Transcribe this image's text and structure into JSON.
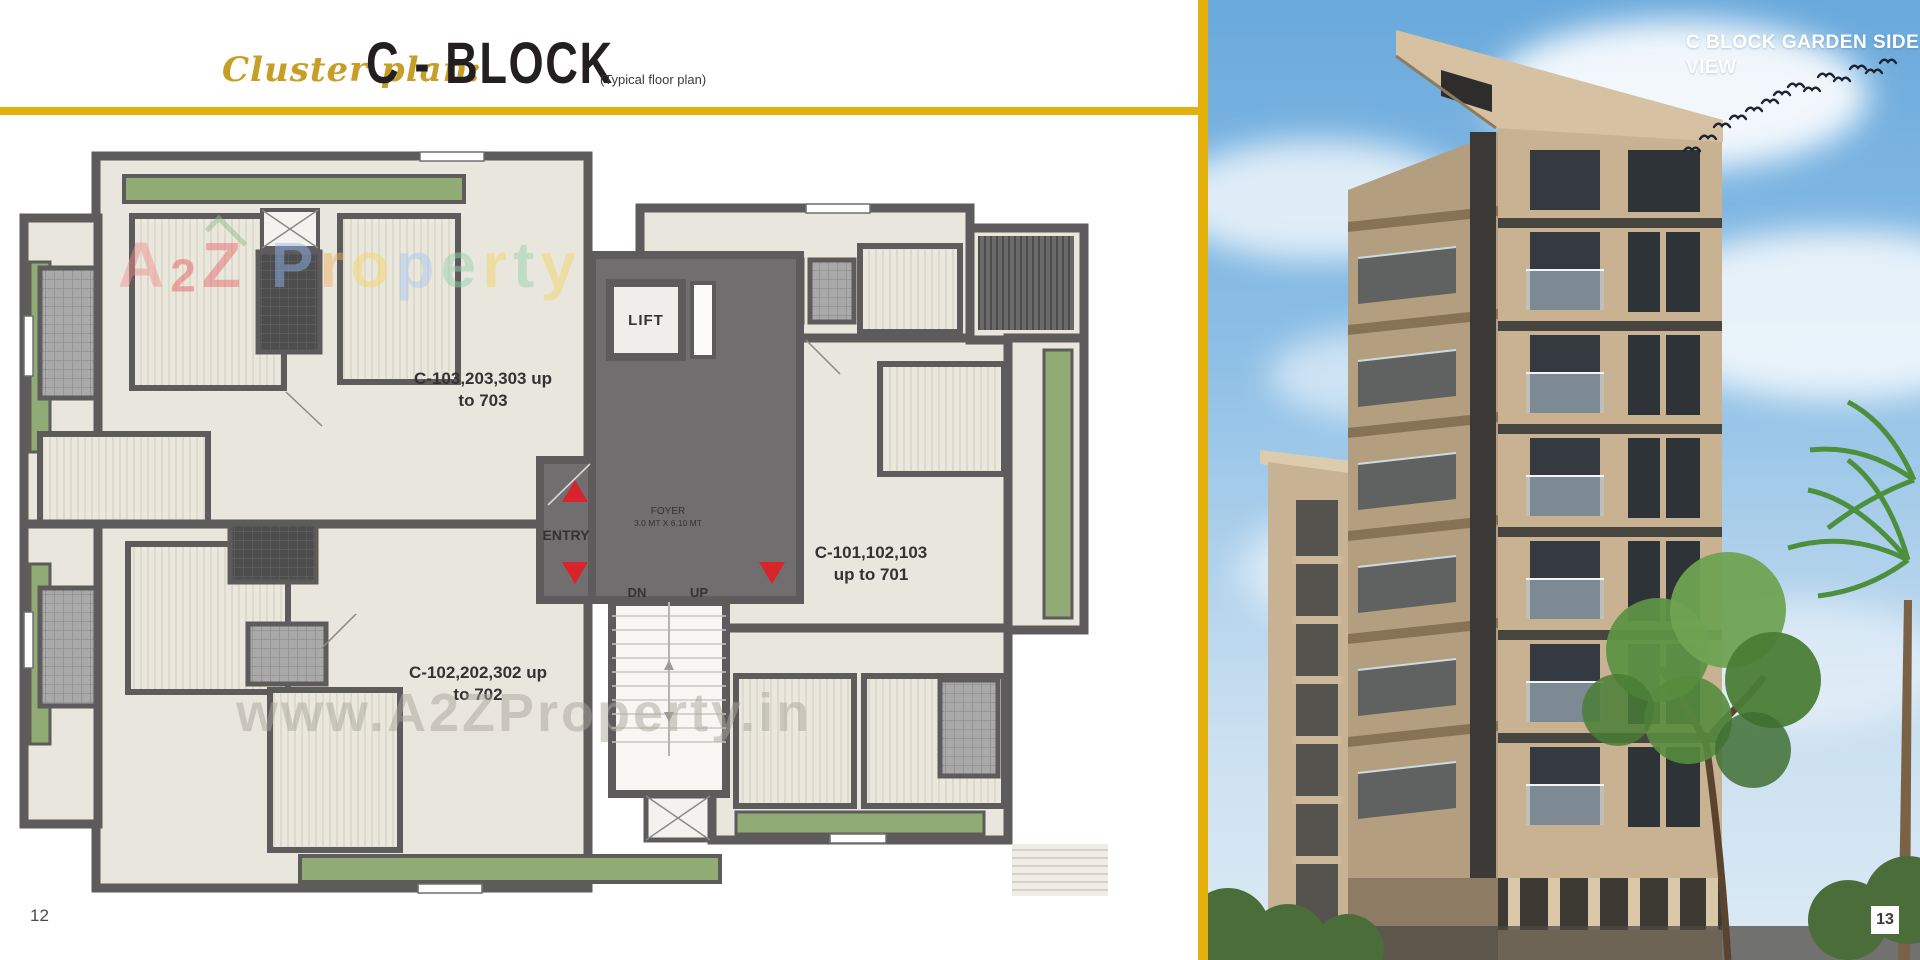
{
  "header": {
    "script_label": "Cluster plan:",
    "title": "C - BLOCK",
    "subtitle": "(Typical floor plan)"
  },
  "plan": {
    "lift": "LIFT",
    "entry": "ENTRY",
    "foyer_line1": "FOYER",
    "foyer_line2": "3.0 MT X 6.10 MT",
    "dn": "DN",
    "up": "UP",
    "unit_top": {
      "line1": "C-103,203,303 up",
      "line2": "to 703"
    },
    "unit_bottom": {
      "line1": "C-102,202,302 up",
      "line2": "to 702"
    },
    "unit_right": {
      "line1": "C-101,102,103",
      "line2": "up to 701"
    }
  },
  "watermarks": {
    "brand_letters": [
      {
        "ch": "A",
        "c": "#f08f8f"
      },
      {
        "ch": "2",
        "c": "#e85c5c"
      },
      {
        "ch": "Z",
        "c": "#ea6868"
      },
      {
        "ch": " ",
        "c": ""
      },
      {
        "ch": "P",
        "c": "#8fb4ee"
      },
      {
        "ch": "r",
        "c": "#f2ae62"
      },
      {
        "ch": "o",
        "c": "#f5d565"
      },
      {
        "ch": "p",
        "c": "#a9c6f2"
      },
      {
        "ch": "e",
        "c": "#93d2a9"
      },
      {
        "ch": "r",
        "c": "#f5d565"
      },
      {
        "ch": "t",
        "c": "#93d2a9"
      },
      {
        "ch": "y",
        "c": "#f5d565"
      }
    ],
    "url": "www.A2ZProperty.in"
  },
  "photo": {
    "caption_line1": "C BLOCK GARDEN SIDE",
    "caption_line2": "VIEW"
  },
  "footer": {
    "left_page_number": "12",
    "right_page_number": "13"
  },
  "colors": {
    "gold": "#E4B10C",
    "ink": "#231F20",
    "scriptgold": "#C79F27",
    "wall": "#5D5B5C",
    "room": "#E9E6DD",
    "foyer": "#706E6F",
    "green": "#90AB74",
    "red": "#D8232A",
    "label": "#343233",
    "skytop": "#69A9DC",
    "skybottom": "#C9DFF0",
    "front": "#C9B291",
    "side": "#B49E80"
  }
}
